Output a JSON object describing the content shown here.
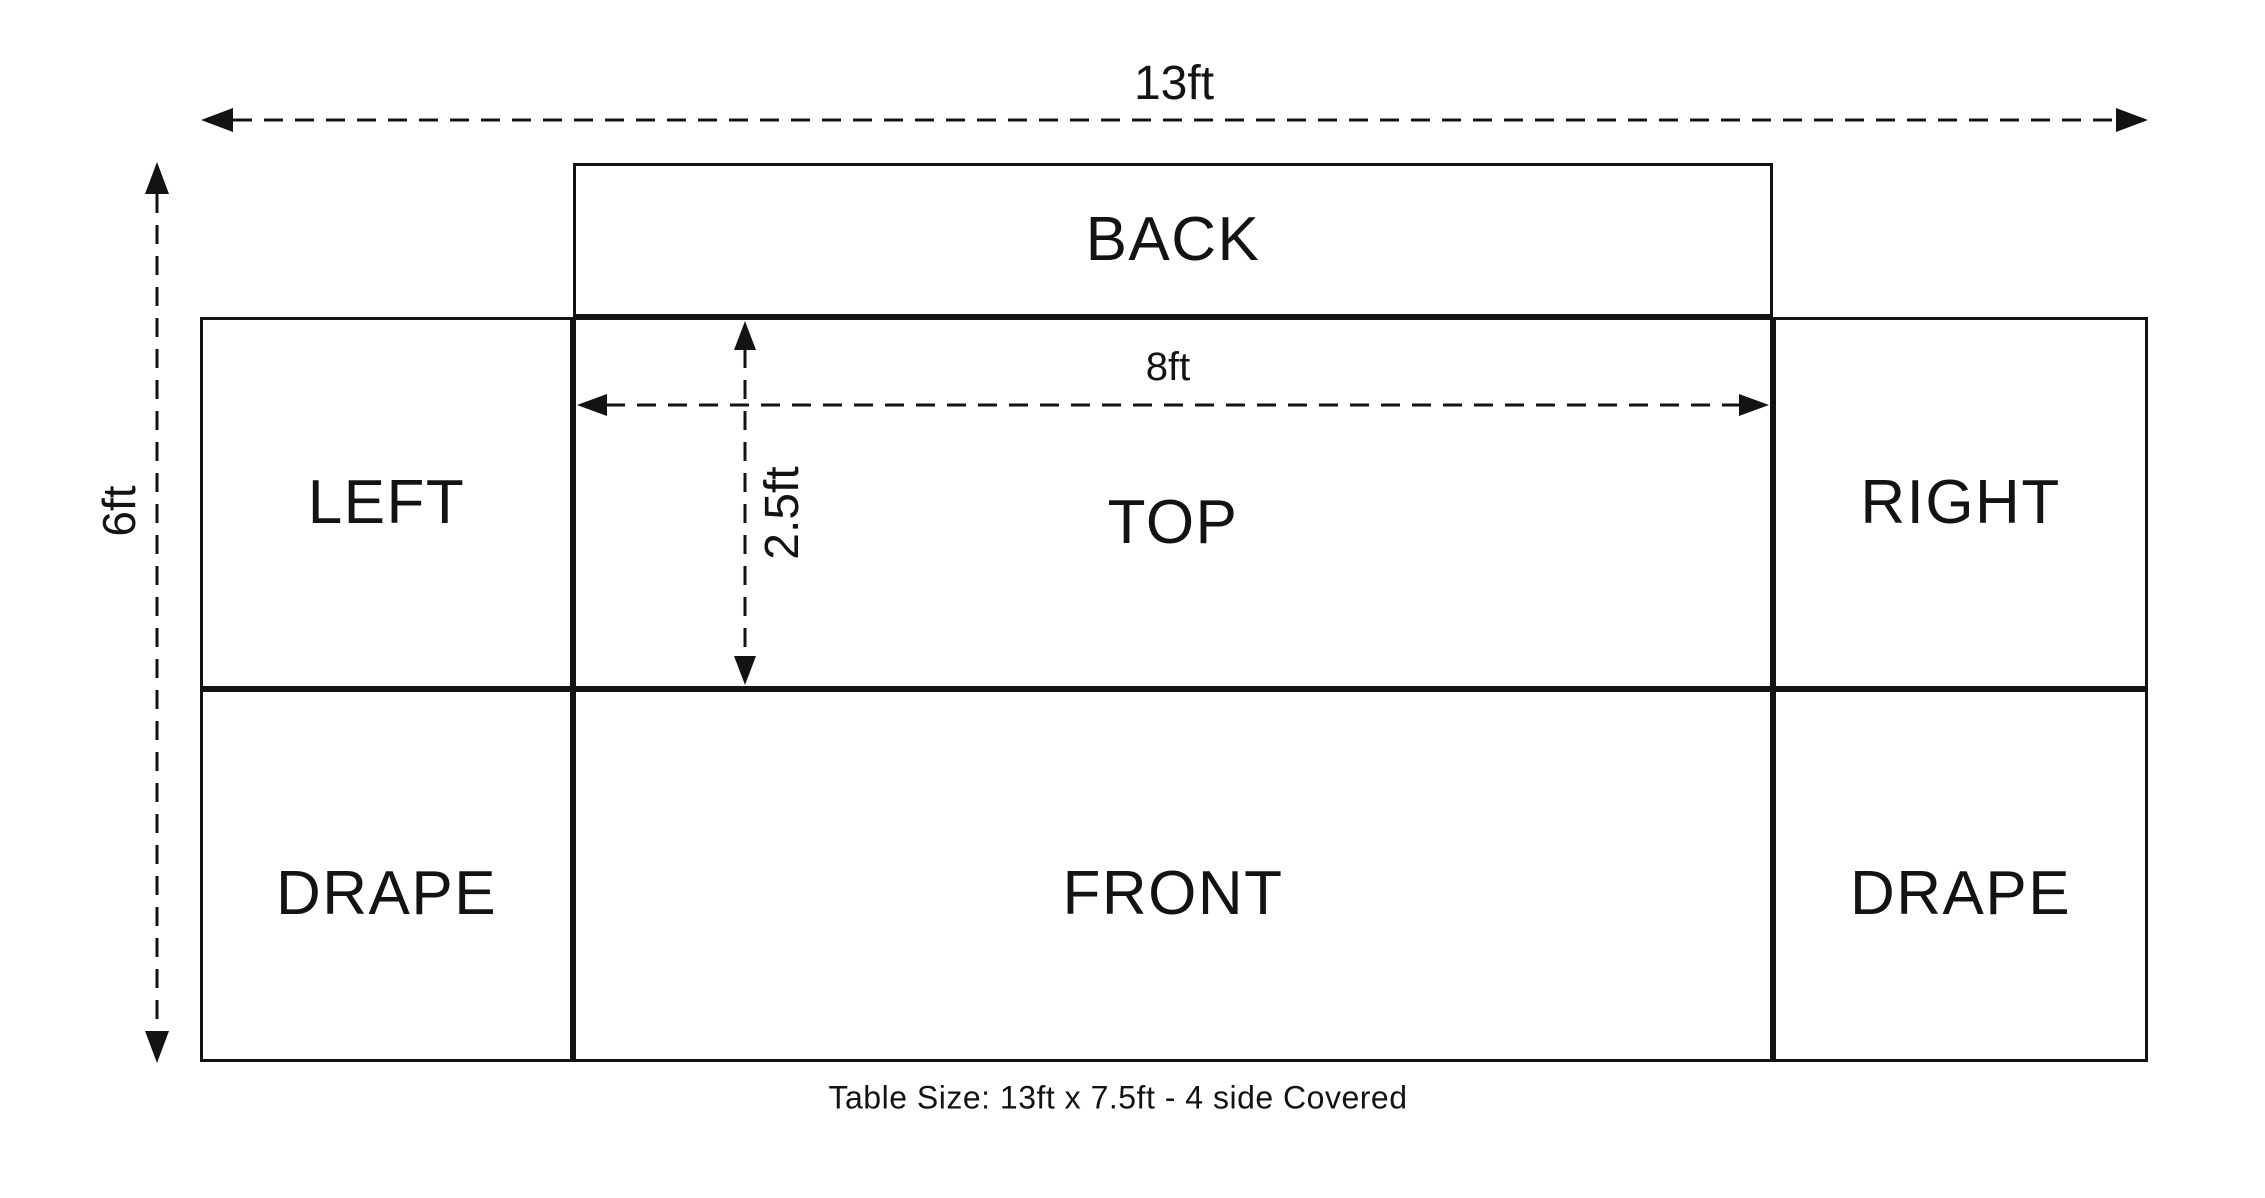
{
  "diagram": {
    "panels": {
      "back": "BACK",
      "left": "LEFT",
      "top": "TOP",
      "right": "RIGHT",
      "drape_left": "DRAPE",
      "front": "FRONT",
      "drape_right": "DRAPE"
    },
    "dimension_labels": {
      "total_width": "13ft",
      "total_height": "6ft",
      "top_width": "8ft",
      "top_depth": "2.5ft"
    },
    "caption": "Table Size: 13ft x 7.5ft - 4 side Covered",
    "colors": {
      "line": "#131313",
      "background": "#ffffff"
    }
  }
}
